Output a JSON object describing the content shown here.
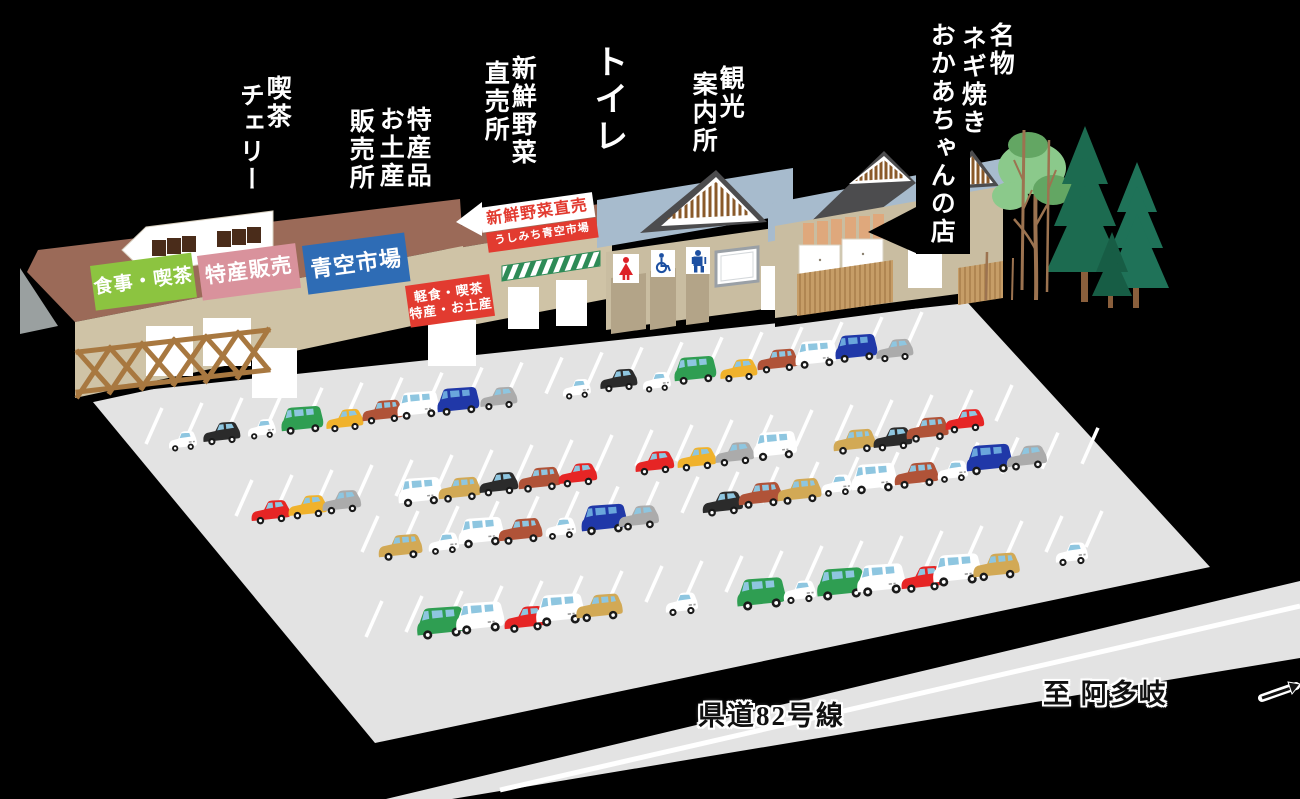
{
  "scene": {
    "width": 1300,
    "height": 799,
    "background": "#000000"
  },
  "facility_labels": [
    {
      "name": "label-kissa-cherry",
      "font": 25,
      "bold": false,
      "cols": [
        {
          "t": "喫茶",
          "x": 263,
          "y": 75
        },
        {
          "t": "チェリー",
          "x": 236,
          "y": 82
        }
      ]
    },
    {
      "name": "label-tokusan-omiyage",
      "font": 25,
      "bold": false,
      "cols": [
        {
          "t": "特産品",
          "x": 403,
          "y": 106
        },
        {
          "t": "お土産",
          "x": 376,
          "y": 106
        },
        {
          "t": "販売所",
          "x": 346,
          "y": 108
        }
      ]
    },
    {
      "name": "label-shinsen-yasai",
      "font": 25,
      "bold": false,
      "cols": [
        {
          "t": "新鮮野菜",
          "x": 508,
          "y": 55
        },
        {
          "t": "直売所",
          "x": 481,
          "y": 60
        }
      ]
    },
    {
      "name": "label-toilet",
      "font": 34,
      "bold": true,
      "cols": [
        {
          "t": "トイレ",
          "x": 589,
          "y": 44
        }
      ]
    },
    {
      "name": "label-kankou-annai",
      "font": 25,
      "bold": false,
      "cols": [
        {
          "t": "観光",
          "x": 716,
          "y": 65
        },
        {
          "t": "案内所",
          "x": 689,
          "y": 71
        }
      ]
    },
    {
      "name": "label-okaachan",
      "font": 25,
      "bold": false,
      "cols": [
        {
          "t": "名物",
          "x": 986,
          "y": 22
        },
        {
          "t": "ネギ焼き",
          "x": 958,
          "y": 25
        },
        {
          "t": "おかあちゃんの店",
          "x": 927,
          "y": 22
        }
      ]
    }
  ],
  "building_signs": [
    {
      "name": "sign-meal-cafe",
      "text": "食事・喫茶",
      "bg": "#8cc440",
      "fg": "#ffffff",
      "x": 90,
      "y": 266,
      "w": 102,
      "h": 45,
      "rot": -7.5,
      "font": 19
    },
    {
      "name": "sign-tokusan-hanbai",
      "text": "特産販売",
      "bg": "#d9929c",
      "fg": "#ffffff",
      "x": 197,
      "y": 256,
      "w": 99,
      "h": 45,
      "rot": -7.5,
      "font": 21
    },
    {
      "name": "sign-aozora-ichiba",
      "text": "青空市場",
      "bg": "#2e6cb5",
      "fg": "#ffffff",
      "x": 302,
      "y": 246,
      "w": 103,
      "h": 49,
      "rot": -7.5,
      "font": 22
    },
    {
      "name": "sign-keishoku",
      "lines": [
        "軽食・喫茶",
        "特産・お土産"
      ],
      "bg": "#e23b30",
      "fg": "#ffffff",
      "x": 405,
      "y": 286,
      "w": 85,
      "h": 42,
      "rot": -8,
      "font": 13
    },
    {
      "name": "sign-yasai-chokubai",
      "text": "新鮮野菜直売",
      "bg": "#ffffff",
      "fg": "#e23b30",
      "x": 479,
      "y": 208,
      "w": 114,
      "h": 25,
      "rot": -8,
      "font": 16
    },
    {
      "name": "sign-ushimichi",
      "text": "うしみち青空市場",
      "bg": "#e23b30",
      "fg": "#ffffff",
      "x": 486,
      "y": 233,
      "w": 111,
      "h": 20,
      "rot": -8,
      "font": 11
    }
  ],
  "road": {
    "name_label": "県道82号線",
    "direction_label": "至 阿多岐"
  },
  "toilet_icons": [
    "woman-icon",
    "wheelchair-icon",
    "man-icon"
  ],
  "palette": {
    "lot": "#e3e3e3",
    "line": "#ffffff",
    "roof_brown": "#9b6a58",
    "wall_tan": "#cfc3a6",
    "wall_tan2": "#c9bda1",
    "recess": "#b3a488",
    "fence": "#a87840",
    "roof_blue": "#a7bbcd",
    "roof_dark": "#4c4c4e",
    "stripe_brown": "#8a5a2a",
    "slat": "#c69d67",
    "slat_line": "#a87e4b",
    "panel_orange": "#dfa87c",
    "awning_green": "#2e8b57",
    "tree_dark": "#1c6b50",
    "tree_mid": "#1f7258",
    "tree_deep": "#175d45",
    "tree_light": "#8bc98b",
    "tree_shade": "#63a663",
    "trunk": "#9c7350",
    "trunk2": "#8a5f3c",
    "icon_red": "#dd2127",
    "icon_blue": "#1d50a2",
    "monitor_win": "#4a2c1a",
    "shadow_gray": "#9aa0a0"
  },
  "parking": {
    "stall_rows": [
      {
        "x": 162,
        "y": 408,
        "n": 20,
        "dx": 40,
        "dy": -5.05
      },
      {
        "x": 252,
        "y": 480,
        "n": 20,
        "dx": 40,
        "dy": -5.0
      },
      {
        "x": 378,
        "y": 516,
        "n": 19,
        "dx": 40,
        "dy": -4.9
      },
      {
        "x": 382,
        "y": 601,
        "n": 19,
        "dx": 40,
        "dy": -5.0
      }
    ],
    "car_colors": {
      "white": "#ffffff",
      "black": "#2b2b2b",
      "green": "#2f9e52",
      "yellow": "#f0b22c",
      "rust": "#b05338",
      "blue": "#2038a8",
      "gray": "#ababab",
      "red": "#e62525",
      "tan": "#d2a955"
    },
    "rows": [
      {
        "s": 0.92,
        "cars": [
          [
            "k",
            "white",
            183,
            448
          ],
          [
            "c",
            "black",
            222,
            441
          ],
          [
            "k",
            "white",
            262,
            436
          ],
          [
            "v",
            "green",
            303,
            430
          ],
          [
            "c",
            "yellow",
            345,
            428
          ],
          [
            "w",
            "rust",
            383,
            420
          ],
          [
            "v",
            "white",
            419,
            415
          ],
          [
            "v",
            "blue",
            459,
            411
          ],
          [
            "c",
            "gray",
            499,
            406
          ],
          [
            "k",
            "white",
            577,
            396
          ],
          [
            "c",
            "black",
            619,
            388
          ],
          [
            "k",
            "white",
            657,
            389
          ],
          [
            "v",
            "green",
            696,
            380
          ],
          [
            "c",
            "yellow",
            739,
            378
          ],
          [
            "w",
            "rust",
            778,
            369
          ],
          [
            "v",
            "white",
            817,
            364
          ],
          [
            "v",
            "blue",
            857,
            358
          ],
          [
            "c",
            "gray",
            895,
            358
          ]
        ]
      },
      {
        "s": 0.96,
        "cars": [
          [
            "c",
            "red",
            271,
            520
          ],
          [
            "c",
            "yellow",
            308,
            515
          ],
          [
            "c",
            "gray",
            342,
            510
          ],
          [
            "v",
            "white",
            421,
            502
          ],
          [
            "w",
            "tan",
            460,
            498
          ],
          [
            "c",
            "black",
            499,
            492
          ],
          [
            "w",
            "rust",
            540,
            488
          ],
          [
            "c",
            "red",
            578,
            483
          ],
          [
            "c",
            "red",
            655,
            471
          ],
          [
            "c",
            "yellow",
            697,
            467
          ],
          [
            "c",
            "gray",
            735,
            462
          ],
          [
            "v",
            "white",
            776,
            456
          ],
          [
            "w",
            "tan",
            855,
            450
          ],
          [
            "c",
            "black",
            893,
            447
          ],
          [
            "w",
            "rust",
            928,
            438
          ],
          [
            "c",
            "red",
            965,
            429
          ]
        ]
      },
      {
        "s": 1.0,
        "cars": [
          [
            "w",
            "tan",
            401,
            556
          ],
          [
            "k",
            "white",
            444,
            551
          ],
          [
            "v",
            "white",
            482,
            543
          ],
          [
            "w",
            "rust",
            521,
            540
          ],
          [
            "k",
            "white",
            561,
            536
          ],
          [
            "v",
            "blue",
            605,
            530
          ],
          [
            "c",
            "gray",
            639,
            526
          ],
          [
            "c",
            "black",
            723,
            512
          ],
          [
            "w",
            "rust",
            761,
            504
          ],
          [
            "w",
            "tan",
            800,
            500
          ],
          [
            "k",
            "white",
            837,
            493
          ],
          [
            "v",
            "white",
            875,
            489
          ],
          [
            "w",
            "rust",
            917,
            484
          ],
          [
            "k",
            "white",
            953,
            479
          ],
          [
            "v",
            "blue",
            990,
            470
          ],
          [
            "c",
            "gray",
            1027,
            466
          ]
        ]
      },
      {
        "s": 1.06,
        "cars": [
          [
            "v",
            "green",
            442,
            634
          ],
          [
            "v",
            "white",
            481,
            629
          ],
          [
            "c",
            "red",
            526,
            628
          ],
          [
            "v",
            "white",
            561,
            621
          ],
          [
            "w",
            "tan",
            600,
            617
          ],
          [
            "k",
            "white",
            682,
            612
          ],
          [
            "v",
            "green",
            762,
            605
          ],
          [
            "k",
            "white",
            800,
            600
          ],
          [
            "v",
            "green",
            842,
            595
          ],
          [
            "v",
            "white",
            882,
            591
          ],
          [
            "c",
            "red",
            923,
            588
          ],
          [
            "v",
            "white",
            958,
            581
          ],
          [
            "w",
            "tan",
            997,
            576
          ],
          [
            "k",
            "white",
            1072,
            562
          ]
        ]
      }
    ]
  }
}
